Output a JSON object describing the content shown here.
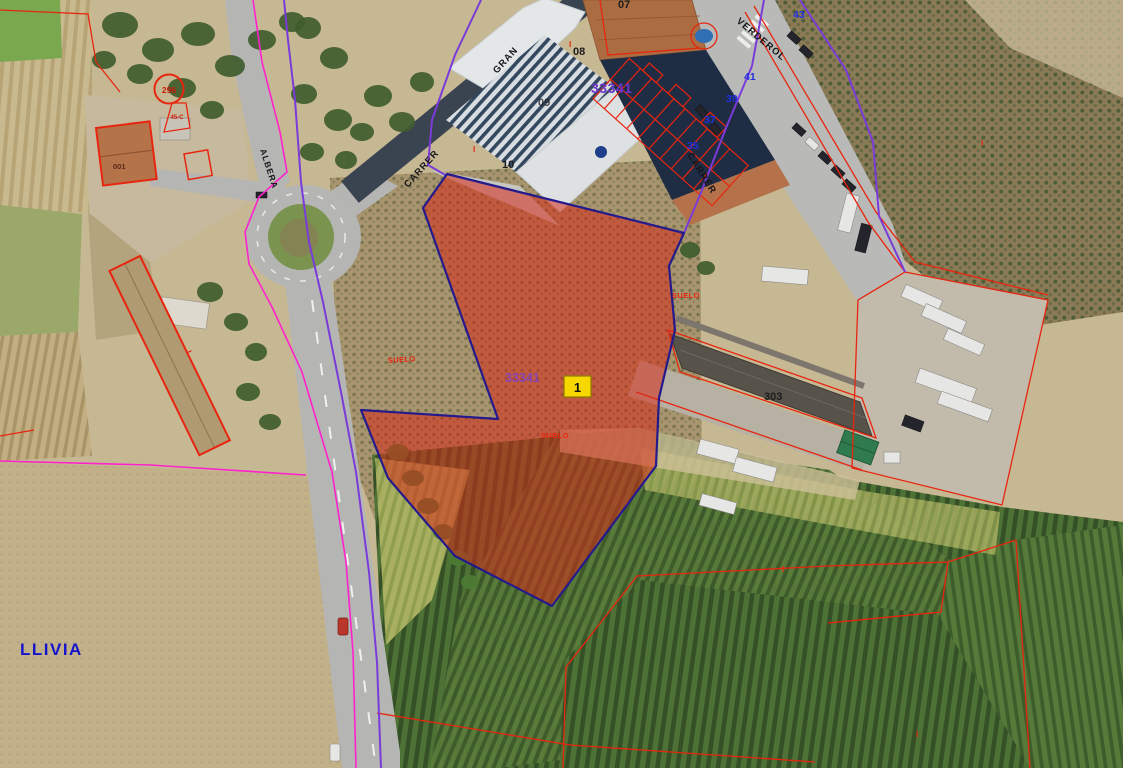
{
  "map_labels": {
    "place": "LLIVIA",
    "zone_primary": "33341",
    "zone_secondary": "33341",
    "selected_parcel": "1",
    "suelo_west": "SUELO",
    "suelo_center": "SUELO",
    "suelo_east": "SUELO",
    "street_gran": "GRAN",
    "street_carrer_gran": "CARRER",
    "street_verderol": "VERDEROL",
    "street_carrer_verderol": "CARRER",
    "street_albera": "ALBERA",
    "house_43": "43",
    "house_41": "41",
    "house_39": "39",
    "house_37": "37",
    "house_35": "35",
    "parcel_07": "07",
    "parcel_08": "08",
    "parcel_09": "09",
    "parcel_10": "10",
    "warehouse_number": "303",
    "cadastral_circle": "296",
    "cadastral_circle_sub": "45-C",
    "building_001": "001",
    "floor_marks": [
      "I",
      "I",
      "I",
      "I",
      "I",
      "I"
    ]
  },
  "colors": {
    "parcel_fill": "#d62a1a",
    "parcel_stroke": "#241a8c",
    "marker_yellow": "#f7d700",
    "cadastral_red": "#e8250f",
    "boundary_magenta": "#ff22cc",
    "boundary_purple": "#7a3bd8",
    "house_number_blue": "#2230e0",
    "zone_purple": "#6a35cc",
    "place_blue": "#1414cc"
  }
}
